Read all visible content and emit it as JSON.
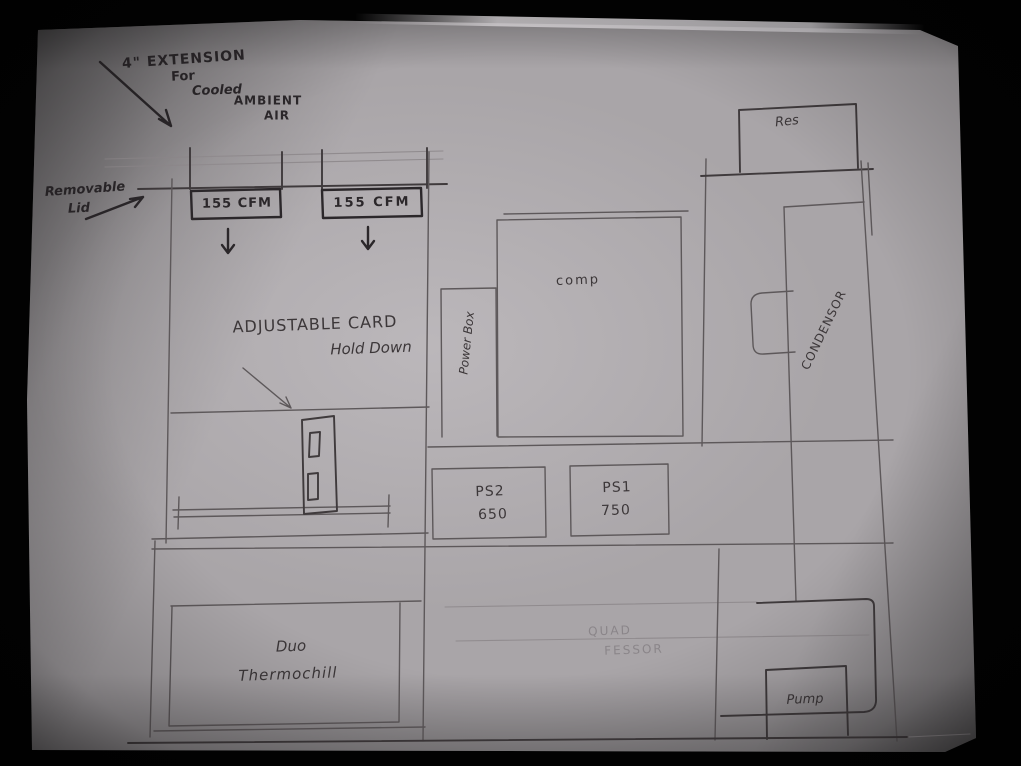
{
  "colors": {
    "background": "#020202",
    "paper": "#a9a5a8",
    "ink": "#2b272a",
    "pencil": "#5d585a",
    "pencil_faint": "#908b8e"
  },
  "annotations": {
    "extension_note": {
      "line1": "4\" EXTENSION",
      "line2": "For",
      "line3": "Cooled",
      "line4": "AMBIENT",
      "line5": "AIR"
    },
    "removable_lid_note": {
      "line1": "Removable",
      "line2": "Lid"
    },
    "card_holddown_note": {
      "line1": "ADJUSTABLE CARD",
      "line2": "Hold Down"
    }
  },
  "components": {
    "fan_left_label": "155 CFM",
    "fan_right_label": "155 CFM",
    "power_box_label": "Power Box",
    "computer_label": "comp",
    "reservoir_label": "Res",
    "condensor_label": "CONDENSOR",
    "psu2": {
      "line1": "PS2",
      "line2": "650"
    },
    "psu1": {
      "line1": "PS1",
      "line2": "750"
    },
    "radiator": {
      "line1": "Duo",
      "line2": "Thermochill"
    },
    "quad_fessor": {
      "line1": "QUAD",
      "line2": "FESSOR"
    },
    "pump_label": "Pump"
  }
}
